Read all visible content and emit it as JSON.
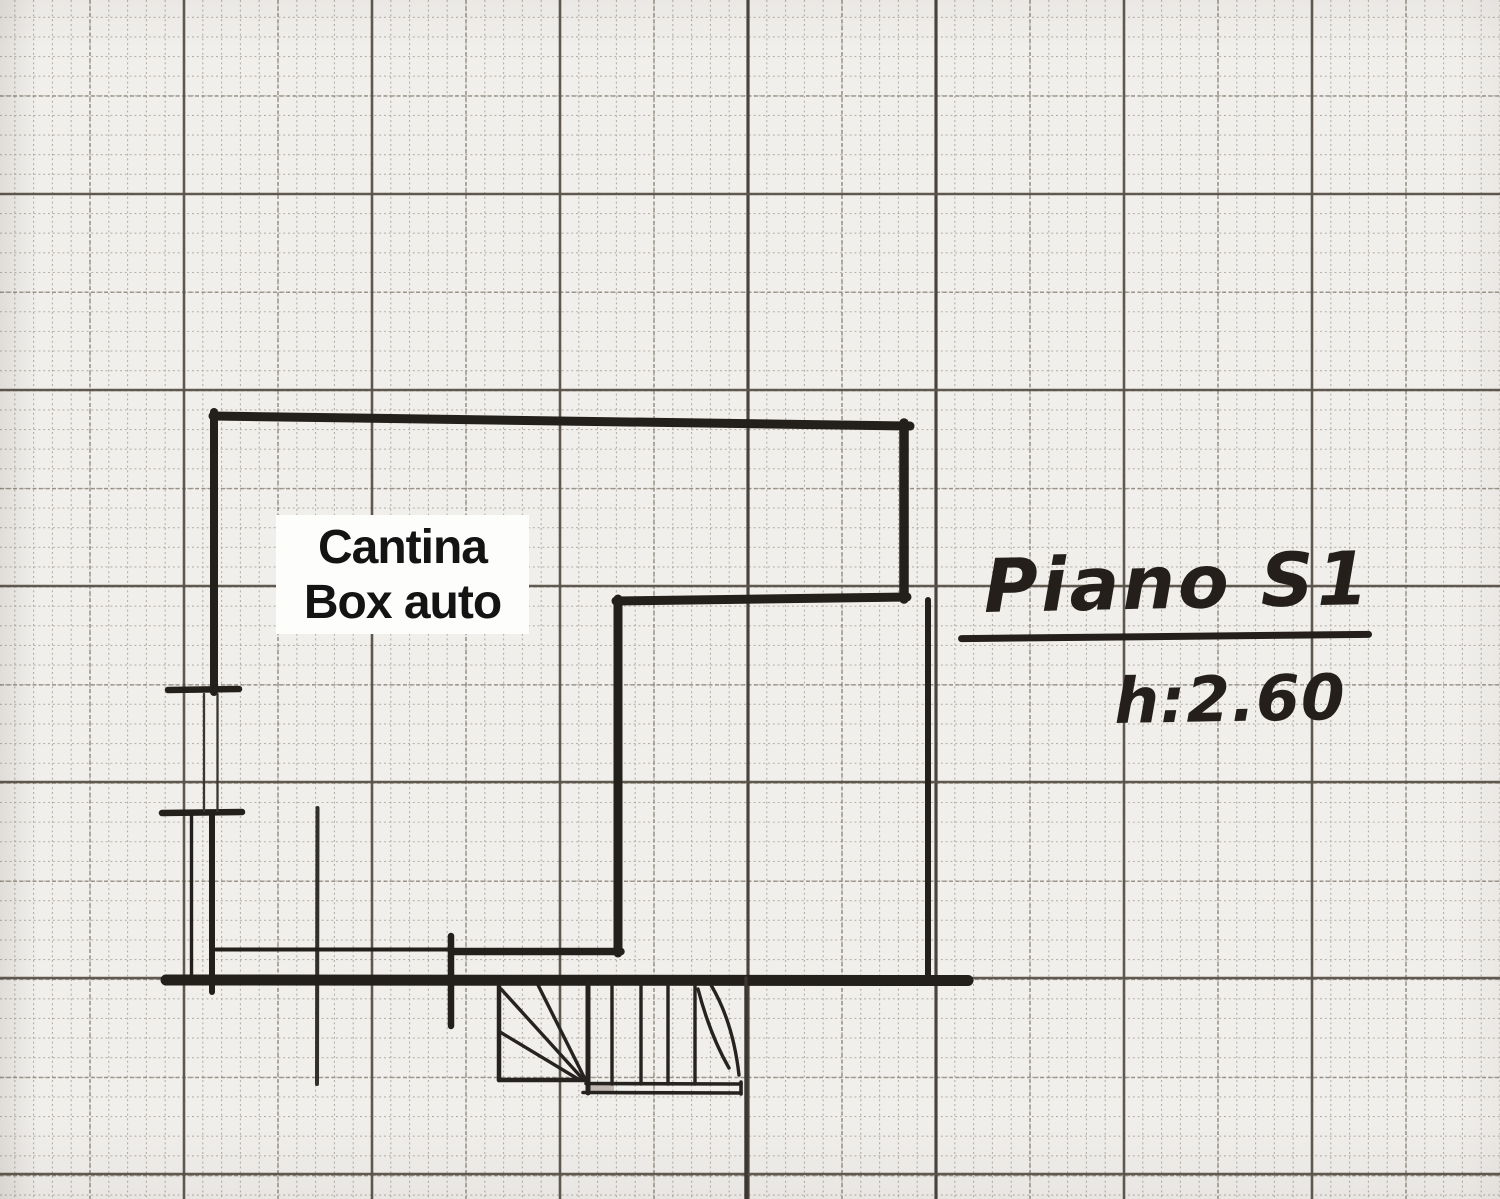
{
  "page": {
    "type": "scanned hand-drawn floor plan sketch on millimeter graph paper",
    "language": "Italian"
  },
  "plan": {
    "room_label": {
      "line1": "Cantina",
      "line2": "Box auto"
    },
    "floor_label": "Piano S1",
    "height_label": "h:2.60"
  },
  "icons": {
    "staircase": "winder-stair-treads",
    "door_opening": "wall-opening-with-jamb-ticks"
  },
  "colors": {
    "paper": "#f1efec",
    "grid_fine": "#aaa49a",
    "grid_medium": "#8a8379",
    "grid_heavy": "#5a5349",
    "grid_heavy_dark": "#46403a",
    "ink": "#231f1a",
    "room_label_text": "#141414",
    "room_label_bg": "#fdfdfc",
    "stair_step_smudge": "#b8ada7"
  }
}
